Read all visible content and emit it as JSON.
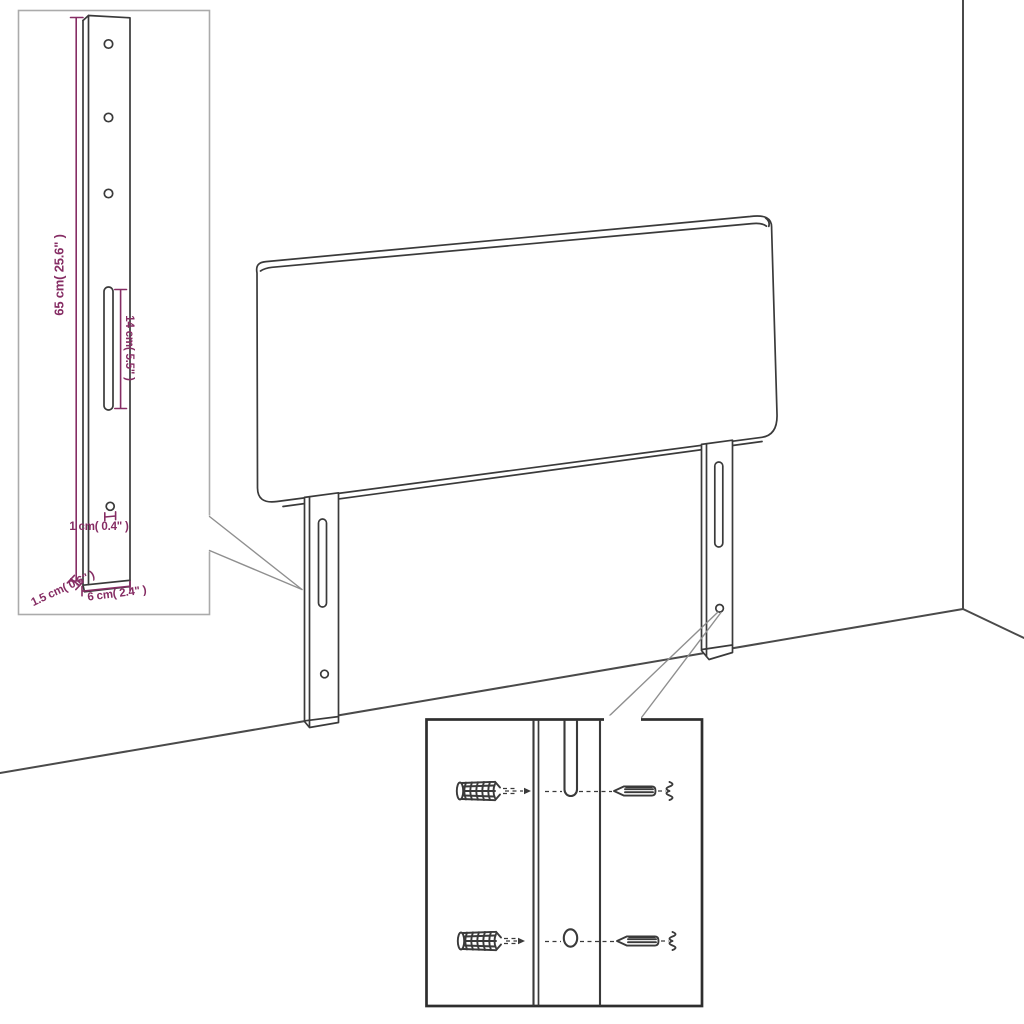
{
  "diagram_title": "headboard-dimension-diagram",
  "labels": {
    "bracket_height": "65 cm( 25.6\" )",
    "slot_length": "14 cm( 5.5\" )",
    "hole_width": "1 cm( 0.4\" )",
    "bracket_thickness": "1.5 cm( 0.6\" )",
    "bracket_width": "6 cm( 2.4\" )"
  },
  "colors": {
    "background": "#ffffff",
    "line_dark": "#3a3a3a",
    "wall_line": "#4a4a4a",
    "inset_border_light": "#ababab",
    "inset_border_dark": "#2e2e2e",
    "callout_line": "#8f8f8f",
    "dimension_text": "#862d64"
  }
}
